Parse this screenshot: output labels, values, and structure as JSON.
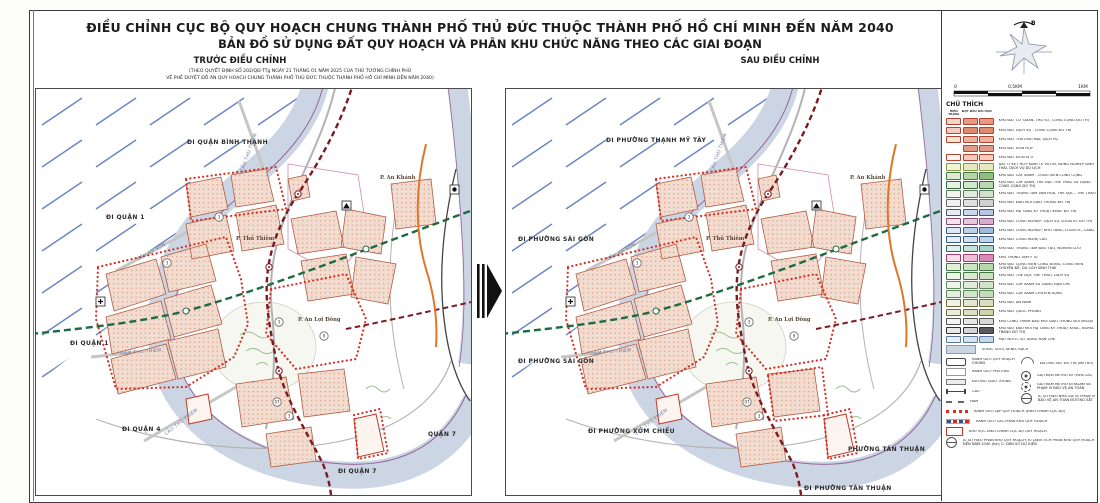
{
  "colors": {
    "river": "#ccd5e3",
    "purple": "#96679b",
    "green": "#1e6b40",
    "darkred": "#7c1a22",
    "adjred": "#d63024",
    "orange": "#e0762a",
    "blockfill": "#f2dcd0",
    "blockstroke": "#b05a42",
    "blockdot": "#d8997f",
    "hatch": "#6b86c2"
  },
  "header": {
    "title_line1": "ĐIỀU CHỈNH CỤC BỘ QUY HOẠCH CHUNG THÀNH PHỐ THỦ ĐỨC THUỘC THÀNH PHỐ HỒ CHÍ MINH ĐẾN NĂM 2040",
    "title_line2": "BẢN ĐỒ SỬ DỤNG ĐẤT QUY HOẠCH VÀ PHÂN KHU CHỨC NĂNG THEO CÁC GIAI ĐOẠN",
    "left_panel_label": "TRƯỚC ĐIỀU CHỈNH",
    "left_panel_sub1": "(THEO QUYẾT ĐỊNH SỐ 202/QĐ-TTg NGÀY 21 THÁNG 01 NĂM 2025 CỦA THỦ TƯỚNG CHÍNH PHỦ",
    "left_panel_sub2": "VỀ PHÊ DUYỆT ĐỒ ÁN QUY HOẠCH CHUNG THÀNH PHỐ THỦ ĐỨC THUỘC THÀNH PHỐ HỒ CHÍ MINH ĐẾN NĂM 2040)",
    "right_panel_label": "SAU ĐIỀU CHỈNH"
  },
  "compass": {
    "north_label": "B"
  },
  "scalebar": {
    "labels": [
      "0",
      "0,5KM",
      "1KM"
    ]
  },
  "maps": {
    "bridges": {
      "thu_thiem": "CẦU THỦ THIÊM",
      "ba_son": "CẦU BA SON",
      "ham": "HẦM THỦ THIÊM",
      "thu_thiem2": "CẦU THỦ THIÊM"
    },
    "wards": {
      "thu_thiem": "P. Thủ Thiêm",
      "an_khanh": "P. An Khánh",
      "an_loi_dong": "P. An Lợi Đông"
    },
    "markers": [
      {
        "n": "3"
      },
      {
        "n": "3"
      },
      {
        "n": "3"
      },
      {
        "n": "9"
      },
      {
        "n": "3"
      },
      {
        "n": "97"
      }
    ],
    "left": {
      "top": "ĐI QUẬN BÌNH THẠNH",
      "left_upper": "ĐI QUẬN 1",
      "left_mid": "ĐI QUẬN 1",
      "bottom_left": "ĐI QUẬN 4",
      "bottom": "ĐI QUẬN 7",
      "corner": "QUẬN 7"
    },
    "right": {
      "top": "ĐI PHƯỜNG THẠNH MỸ TÂY",
      "left_upper": "ĐI PHƯỜNG SÀI GÒN",
      "left_mid": "ĐI PHƯỜNG SÀI GÒN",
      "bottom_left": "ĐI PHƯỜNG XÓM CHIẾU",
      "bottom": "ĐI PHƯỜNG TÂN THUẬN",
      "corner": "PHƯỜNG TÂN THUẬN"
    }
  },
  "legend": {
    "title": "CHÚ THÍCH",
    "col_headers": [
      "HIỆN TRẠNG",
      "ĐỢT ĐẦU",
      "DÀI HẠN"
    ],
    "rows": [
      {
        "label": "KHU ĐẤT CƠ QUAN, TRỤ SỞ, CÔNG CỘNG ĐÔ THỊ",
        "border": "#b4442e",
        "colors": [
          "#f2d7cb",
          "#e59a85",
          "#e59a85"
        ]
      },
      {
        "label": "KHU ĐẤT DỊCH VỤ - CÔNG CỘNG ĐÔ THỊ",
        "border": "#b4442e",
        "colors": [
          "#f0cdbf",
          "#e08a72",
          "#e08a72"
        ]
      },
      {
        "label": "KHU ĐẤT THƯƠNG MẠI, DỊCH VỤ",
        "border": "#b4442e",
        "colors": [
          "#f6e3da",
          "#eab4a2",
          "#eab4a2"
        ]
      },
      {
        "label": "KHU ĐẤT HỖN HỢP",
        "border": "#b4442e",
        "colors": [
          null,
          "#e59a85",
          "#e59a85"
        ]
      },
      {
        "label": "KHU ĐẤT ĐƠN VỊ Ở",
        "border": "#b4442e",
        "colors": [
          "#fdf4ef",
          "#f4cdbd",
          "#f4cdbd"
        ]
      },
      {
        "label": "ĐẤT Ở KẾT HỢP KINH TẾ VƯỜN, NÔNG NGHIỆP SINH THÁI, DỊCH VỤ DU LỊCH",
        "border": "#8a9a3a",
        "colors": [
          "#f0f2da",
          "#e6e9bd",
          "#e6e9bd"
        ]
      },
      {
        "label": "KHU ĐẤT CÂY XANH - CÔNG VIÊN CÔNG CỘNG",
        "border": "#3f7a42",
        "colors": [
          "#dcead2",
          "#b5d4a8",
          "#8fbe80"
        ]
      },
      {
        "label": "KHU ĐẤT CÂY XANH, THỂ DỤC THỂ THAO SỬ DỤNG CÔNG CỘNG ĐÔ THỊ",
        "border": "#2f6b3a",
        "colors": [
          "#e9f1e4",
          "#d3e5ca",
          "#bcd8b1"
        ]
      },
      {
        "label": "KHU ĐẤT TRUNG TÂM VĂN HÓA, THỂ DỤC - THỂ THAO",
        "border": "#5a7a5a",
        "colors": [
          "#f1f5ee",
          "#e0ebdb",
          "#cfe1c8"
        ]
      },
      {
        "label": "KHU ĐẤT ĐẦU MỐI GIAO THÔNG ĐÔ THỊ",
        "border": "#666666",
        "colors": [
          "#f0f0f0",
          "#e0e0e0",
          "#d0d0d0"
        ]
      },
      {
        "label": "KHU ĐẤT HẠ TẦNG KỸ THUẬT KHÁC ĐÔ THỊ",
        "border": "#44557a",
        "colors": [
          "#e6ebf4",
          "#cdd8ec",
          "#b4c6e2"
        ]
      },
      {
        "label": "KHU ĐẤT CÔNG NGHIỆP, DỊCH VỤ, LOGISTIC ĐÔ THỊ",
        "border": "#8a4a7a",
        "colors": [
          "#f3e4ee",
          "#e6c8dd",
          "#d8accd"
        ]
      },
      {
        "label": "KHU ĐẤT CÔNG NGHIỆP, KHO TÀNG, LOGISTIC, CẢNG",
        "border": "#3a5a8a",
        "colors": [
          "#dfe8f3",
          "#bed2e9",
          "#9cbbde"
        ]
      },
      {
        "label": "KHU ĐẤT CÔNG NGHỆ CAO",
        "border": "#3a5a8a",
        "colors": [
          "#e7eef6",
          "#d2e1f0",
          "#bdd4ea"
        ]
      },
      {
        "label": "KHU ĐẤT TRUNG TÂM ĐÀO TẠO, NGHIÊN CỨU",
        "border": "#2a6a5a",
        "colors": [
          "#e0efeb",
          "#c4e2da",
          "#a8d5c9"
        ]
      },
      {
        "label": "KHU TRUNG TÂM Y TẾ",
        "border": "#a43a6a",
        "colors": [
          "#f6e0eb",
          "#edc0d6",
          "#d88ab4"
        ]
      },
      {
        "label": "KHU ĐẤT CÔNG VIÊN CỘNG ĐỒNG, CÔNG VIÊN CHUYÊN ĐỀ, DU LỊCH SINH THÁI",
        "border": "#3f7a42",
        "colors": [
          "#e4efdc",
          "#cfe4c2",
          "#b9d8a8"
        ]
      },
      {
        "label": "KHU ĐẤT THỂ DỤC THỂ THAO, DỊCH VỤ",
        "border": "#3f7a42",
        "colors": [
          "#ecf3e7",
          "#dcead3",
          "#cce0bf"
        ]
      },
      {
        "label": "KHU ĐẤT CÂY XANH SỬ DỤNG HẠN CHẾ",
        "border": "#5a8a5a",
        "colors": [
          "#eef4ea",
          "#e0ecd9",
          "#d2e4c8"
        ]
      },
      {
        "label": "KHU ĐẤT CÂY XANH CHUYÊN DỤNG",
        "border": "#5a8a5a",
        "colors": [
          "#e6eee0",
          "#d5e5cc",
          "#c4dcb8"
        ]
      },
      {
        "label": "KHU ĐẤT AN NINH",
        "border": "#6a6a3a",
        "colors": [
          "#f0f2e6",
          "#e4e8d2",
          "#d8debe"
        ]
      },
      {
        "label": "KHU ĐẤT QUỐC PHÒNG",
        "border": "#6a6a3a",
        "colors": [
          "#eaedda",
          "#dbe1c2",
          "#ccd5aa"
        ]
      },
      {
        "label": "KHU CÔNG TRÌNH ĐẦU MỐI GIAO THÔNG ĐỐI NGOẠI",
        "border": "#555555",
        "colors": [
          "#f4f4f4",
          "#e6e6e6",
          "#d8d8d8"
        ]
      },
      {
        "label": "KHU ĐẤT ĐẦU MỐI HẠ TẦNG KỸ THUẬT KHÁC, NGHĨA TRANG ĐÔ THỊ",
        "border": "#333333",
        "colors": [
          "#e8e8ea",
          "#d4d4d8",
          "#5a5a62"
        ]
      },
      {
        "label": "MẶT NƯỚC SỬ DỤNG HẠN CHẾ",
        "border": "#5a7aa0",
        "colors": [
          "#e9eef5",
          "#d8e2ef",
          "#c6d6e9"
        ]
      }
    ],
    "river_row": {
      "t": "river",
      "l": "SÔNG, SUỐI, KÊNH, RẠCH"
    },
    "sym_col_a": [
      {
        "t": "rect1",
        "l": "RANH GIỚI QUY HOẠCH CHUNG"
      },
      {
        "t": "rect2",
        "l": "RANH GIỚI PHƯỜNG"
      },
      {
        "t": "road",
        "l": "ĐƯỜNG GIAO THÔNG"
      },
      {
        "t": "bridge",
        "l": "CẦU"
      },
      {
        "t": "tunnel",
        "l": "HẦM"
      }
    ],
    "sym_col_b": [
      {
        "t": "metro",
        "l": "ĐƯỜNG SẮT ĐÔ THỊ (METRO)"
      },
      {
        "t": "station",
        "l": "GA/TRẠM METRO ĐI TRÊN CAO"
      },
      {
        "t": "stationu",
        "l": "GA/TRẠM METRO ĐI NGẦM VÀ PHẠM VI BẢO VỆ AN TOÀN"
      },
      {
        "t": "abc",
        "l": "A: SỐ HIỆU NHÀ GA; B: PHẠM VI BẢO VỆ AN TOÀN ĐƯỜNG SẮT"
      }
    ],
    "symbols_full": [
      {
        "t": "reddots",
        "l": "RANH GIỚI LẬP QUY HOẠCH (ĐIỀU CHỈNH CỤC BỘ)"
      },
      {
        "t": "subzone",
        "l": "RANH GIỚI CÁC PHÂN KHU QUY HOẠCH"
      },
      {
        "t": "redrect",
        "l": "KHU VỰC ĐIỀU CHỈNH CỤC BỘ QUY HOẠCH"
      },
      {
        "t": "abc",
        "l": "A: SỐ HIỆU PHÂN KHU QUY HOẠCH; B: DIỆN TÍCH PHÂN KHU QUY HOẠCH ĐẾN NĂM 2040 (ha); C: DÂN SỐ DỰ KIẾN"
      }
    ]
  }
}
